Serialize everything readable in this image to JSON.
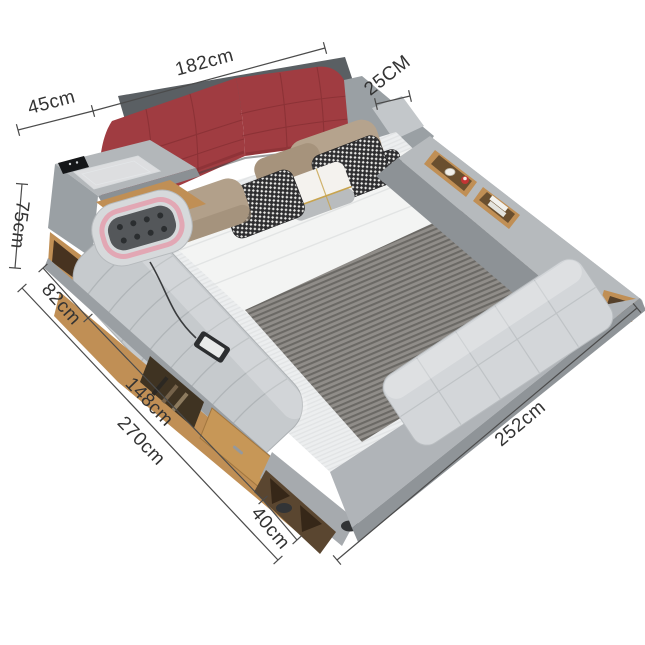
{
  "description": "Multifunctional upholstered smart platform bed shown in perspective with dimension callouts",
  "dims": {
    "console_width": {
      "label": "45cm"
    },
    "headboard_width": {
      "label": "182cm"
    },
    "right_rail_width": {
      "label": "25CM"
    },
    "headboard_height": {
      "label": "75cm"
    },
    "chaise_width": {
      "label": "82cm"
    },
    "side_length": {
      "label": "148cm"
    },
    "overall_length": {
      "label": "270cm"
    },
    "corner_width": {
      "label": "40cm"
    },
    "bed_length": {
      "label": "252cm"
    }
  },
  "colors": {
    "background": "#ffffff",
    "dimension_line": "#4b4b4b",
    "dimension_text": "#333333",
    "headboard_red": "#a03c41",
    "frame_gray": "#a8acb0",
    "upholstery_light": "#c6cacd",
    "wood": "#c08f55",
    "blanket_gray": "#8d8a86",
    "massage_pink": "#e2a7b4"
  }
}
